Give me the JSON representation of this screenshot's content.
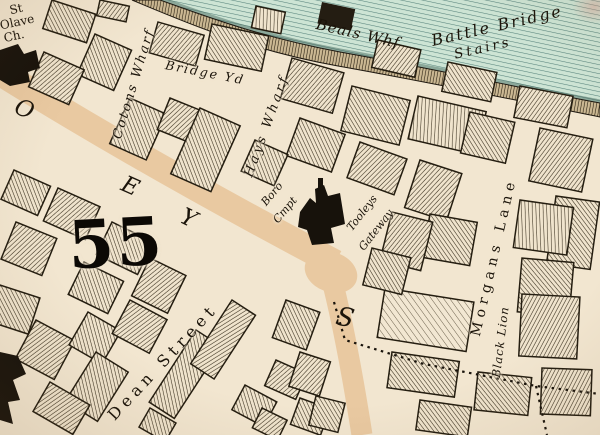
{
  "map": {
    "type": "historical-engraved-street-map",
    "grid_number": "55",
    "street_letters": [
      "O",
      "E",
      "Y",
      "S"
    ],
    "water_labels": {
      "beals_wharf": "Beals Whf",
      "battle_bridge_line1": "Battle Bridge",
      "battle_bridge_line2": "Stairs"
    },
    "places": {
      "st_olave_line1": "St",
      "st_olave_line2": "Olave",
      "st_olave_line3": "Ch.",
      "cotons_wharf": "Cotons Wharf",
      "bridge_yard": "Bridge Yd",
      "hays_wharf": "Hays Wharf",
      "boro_compter_line1": "Boro",
      "boro_compter_line2": "Cmpt",
      "gateway_line1": "Tooleys",
      "gateway_line2": "Gateway",
      "dean_street": "Dean Street",
      "morgans_lane": "Morgans Lane",
      "black_lion": "Black Lion"
    },
    "colors": {
      "water": "#cde4d4",
      "water_line": "#57837a",
      "land": "#f2e6d0",
      "street": "#e9c9a1",
      "ink": "#221b10"
    }
  }
}
